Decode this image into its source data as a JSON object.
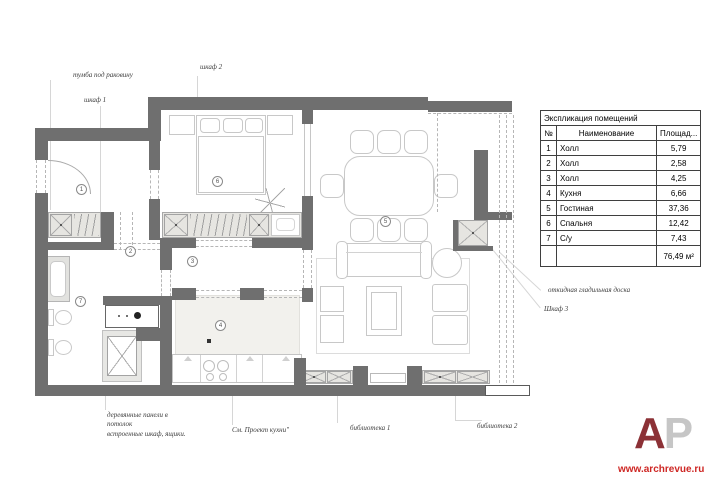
{
  "plan": {
    "rooms": [
      {
        "num": "1"
      },
      {
        "num": "2"
      },
      {
        "num": "3"
      },
      {
        "num": "4"
      },
      {
        "num": "5"
      },
      {
        "num": "6"
      },
      {
        "num": "7"
      }
    ]
  },
  "annotations": {
    "tumba": "тумба под раковину",
    "shkaf1": "шкаф 1",
    "shkaf2": "шкаф 2",
    "wood_panels": "деревянные панели в потолок",
    "built_in": "встроенные шкаф, ящики.",
    "see_kitchen": "См. Проект кухни\"",
    "lib1": "библиотека 1",
    "lib2": "библиотека 2",
    "ironing": "откидная гладильная доска",
    "shkaf3": "Шкаф 3"
  },
  "explication": {
    "title": "Экспликация помещений",
    "columns": {
      "num": "№",
      "name": "Наименование",
      "area": "Площад..."
    },
    "rows": [
      {
        "num": "1",
        "name": "Холл",
        "area": "5,79"
      },
      {
        "num": "2",
        "name": "Холл",
        "area": "2,58"
      },
      {
        "num": "3",
        "name": "Холл",
        "area": "4,25"
      },
      {
        "num": "4",
        "name": "Кухня",
        "area": "6,66"
      },
      {
        "num": "5",
        "name": "Гостиная",
        "area": "37,36"
      },
      {
        "num": "6",
        "name": "Спальня",
        "area": "12,42"
      },
      {
        "num": "7",
        "name": "С/у",
        "area": "7,43"
      }
    ],
    "total": "76,49 м²"
  },
  "branding": {
    "logo_a": "А",
    "logo_p": "Р",
    "url": "www.archrevue.ru"
  },
  "colors": {
    "wall": "#6f6f6f",
    "furniture_line": "#c8c8c8",
    "wardrobe_fill": "#e6e5e1",
    "logo_red": "#8c3136",
    "url_red": "#ce2724"
  }
}
